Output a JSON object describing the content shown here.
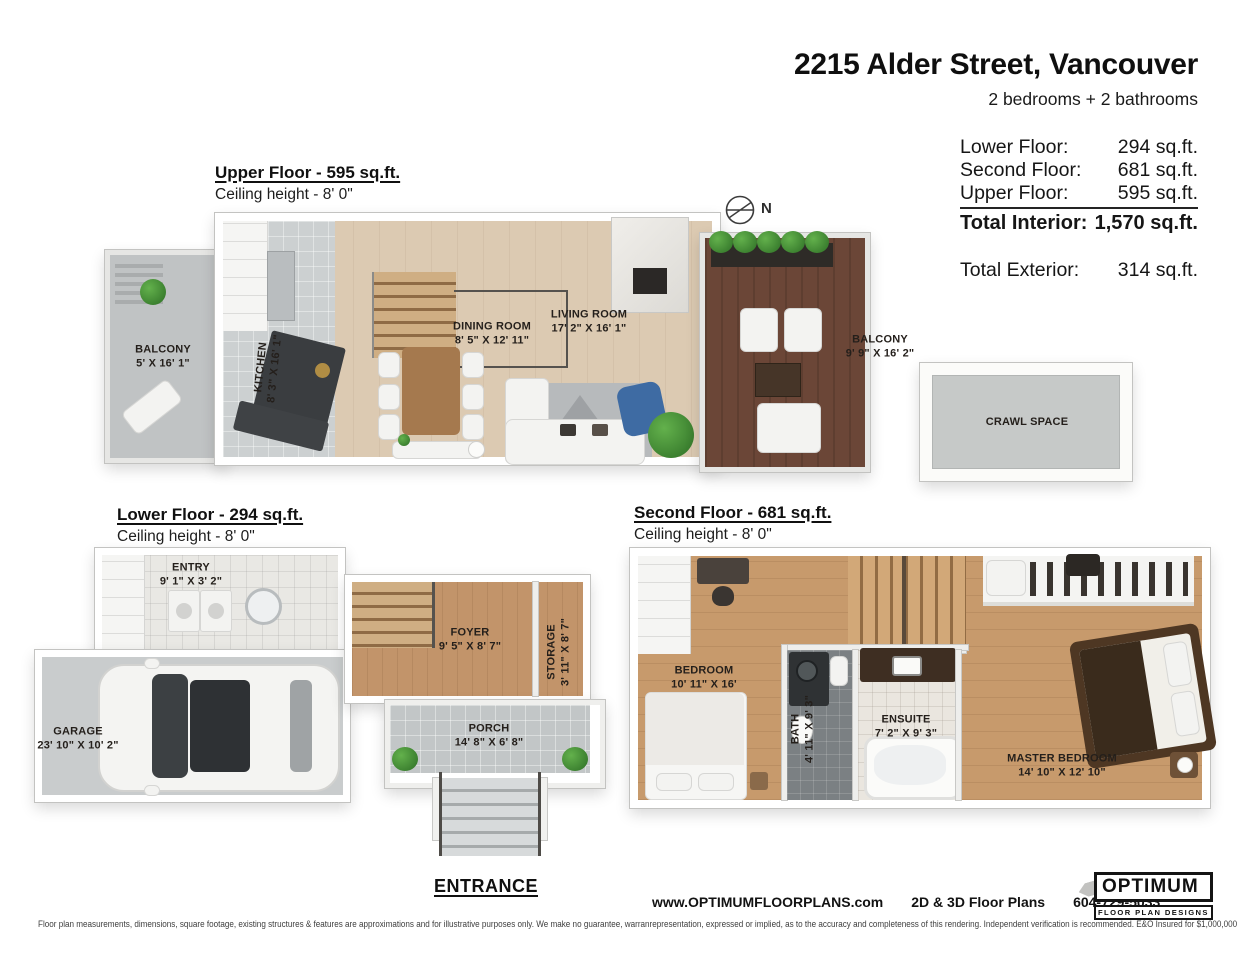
{
  "header": {
    "address": "2215 Alder Street, Vancouver",
    "subtitle": "2 bedrooms + 2 bathrooms",
    "area_rows": [
      {
        "label": "Lower Floor:",
        "value": "294 sq.ft."
      },
      {
        "label": "Second Floor:",
        "value": "681 sq.ft."
      },
      {
        "label": "Upper Floor:",
        "value": "595 sq.ft."
      },
      {
        "label": "Total Interior:",
        "value": "1,570 sq.ft."
      }
    ],
    "exterior": {
      "label": "Total Exterior:",
      "value": "314 sq.ft."
    }
  },
  "floors": {
    "upper": {
      "title": "Upper Floor - 595 sq.ft.",
      "ceiling": "Ceiling height - 8' 0\""
    },
    "lower": {
      "title": "Lower Floor - 294 sq.ft.",
      "ceiling": "Ceiling height - 8' 0\""
    },
    "second": {
      "title": "Second Floor - 681 sq.ft.",
      "ceiling": "Ceiling height - 8' 0\""
    }
  },
  "compass": {
    "label": "N"
  },
  "rooms": {
    "balcony_left": {
      "name": "BALCONY",
      "dims": "5' X 16' 1\""
    },
    "kitchen": {
      "name": "KITCHEN",
      "dims": "8' 3\" X 16' 1\""
    },
    "dining_room": {
      "name": "DINING ROOM",
      "dims": "8' 5\" X 12' 11\""
    },
    "living_room": {
      "name": "LIVING ROOM",
      "dims": "17' 2\" X 16' 1\""
    },
    "balcony_right": {
      "name": "BALCONY",
      "dims": "9' 9\" X 16' 2\""
    },
    "crawl_space": {
      "name": "CRAWL SPACE"
    },
    "entry": {
      "name": "ENTRY",
      "dims": "9' 1\" X 3' 2\""
    },
    "garage": {
      "name": "GARAGE",
      "dims": "23' 10\" X 10' 2\""
    },
    "foyer": {
      "name": "FOYER",
      "dims": "9' 5\" X 8' 7\""
    },
    "storage": {
      "name": "STORAGE",
      "dims": "3' 11\" X 8' 7\""
    },
    "porch": {
      "name": "PORCH",
      "dims": "14' 8\" X 6' 8\""
    },
    "bedroom": {
      "name": "BEDROOM",
      "dims": "10' 11\" X 16'"
    },
    "bath": {
      "name": "BATH",
      "dims": "4' 11\" X 9' 3\""
    },
    "ensuite": {
      "name": "ENSUITE",
      "dims": "7' 2\" X 9' 3\""
    },
    "master_bedroom": {
      "name": "MASTER BEDROOM",
      "dims": "14' 10\" X 12' 10\""
    }
  },
  "entrance": {
    "label": "ENTRANCE"
  },
  "footer": {
    "website": "www.OPTIMUMFLOORPLANS.com",
    "services": "2D & 3D Floor Plans",
    "phone": "604-729-5033",
    "logo_title": "OPTIMUM",
    "logo_subtitle": "FLOOR PLAN DESIGNS",
    "disclaimer": "Floor plan measurements, dimensions, square footage, existing structures & features are approximations and for illustrative purposes only. We make no guarantee, warranrepresentation, expressed or implied, as to the accuracy and completeness of this rendering. Independent verification is recommended. E&O Insured for $1,000,000"
  },
  "colors": {
    "brand_black": "#141414",
    "wood_upper_floor": "#dccab2",
    "wood_lower_second": "#c79a6c",
    "deck_brown": "#6b4637",
    "tile_gray": "#c2c6c7",
    "blue_armchair": "#3e6ba3",
    "plant_green": "#3f8a34",
    "label_text": "#241f1b"
  }
}
